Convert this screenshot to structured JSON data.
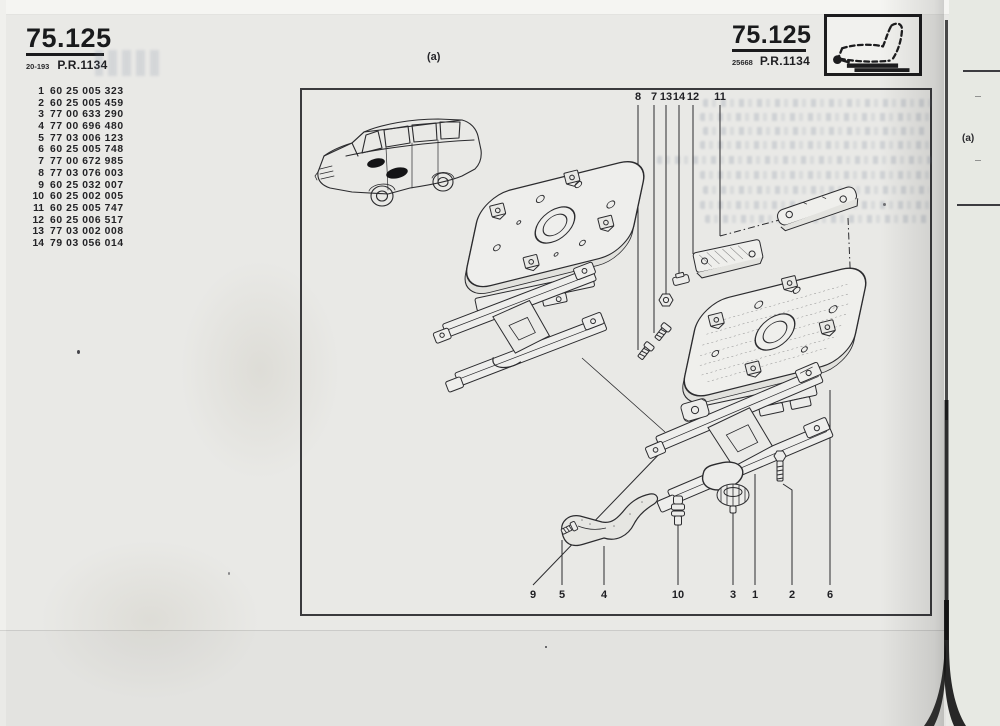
{
  "page": {
    "header_left": {
      "code": "75.125",
      "ref_small": "20-193",
      "pr": "P.R.1134"
    },
    "header_right": {
      "code": "75.125",
      "ref_small": "25668",
      "pr": "P.R.1134"
    },
    "figure_label": "(a)",
    "adjacent_page_label": "(a)"
  },
  "parts_list": [
    {
      "ref": "1",
      "code": "60 25 005 323"
    },
    {
      "ref": "2",
      "code": "60 25 005 459"
    },
    {
      "ref": "3",
      "code": "77 00 633 290"
    },
    {
      "ref": "4",
      "code": "77 00 696 480"
    },
    {
      "ref": "5",
      "code": "77 03 006 123"
    },
    {
      "ref": "6",
      "code": "60 25 005 748"
    },
    {
      "ref": "7",
      "code": "77 00 672 985"
    },
    {
      "ref": "8",
      "code": "77 03 076 003"
    },
    {
      "ref": "9",
      "code": "60 25 032 007"
    },
    {
      "ref": "10",
      "code": "60 25 002 005"
    },
    {
      "ref": "11",
      "code": "60 25 005 747"
    },
    {
      "ref": "12",
      "code": "60 25 006 517"
    },
    {
      "ref": "13",
      "code": "77 03 002 008"
    },
    {
      "ref": "14",
      "code": "79 03 056 014"
    }
  ],
  "callouts": {
    "top": [
      "8",
      "7",
      "13",
      "14",
      "12",
      "11"
    ],
    "bottom": [
      "9",
      "5",
      "4",
      "10",
      "3",
      "1",
      "2",
      "6"
    ]
  },
  "icons": {
    "header_pictogram": "sliding-seat-profile-icon"
  },
  "colors": {
    "paper": "#e9e9e6",
    "ink": "#232326",
    "bleed_text": "#8f9aad",
    "binding": "#141414"
  }
}
